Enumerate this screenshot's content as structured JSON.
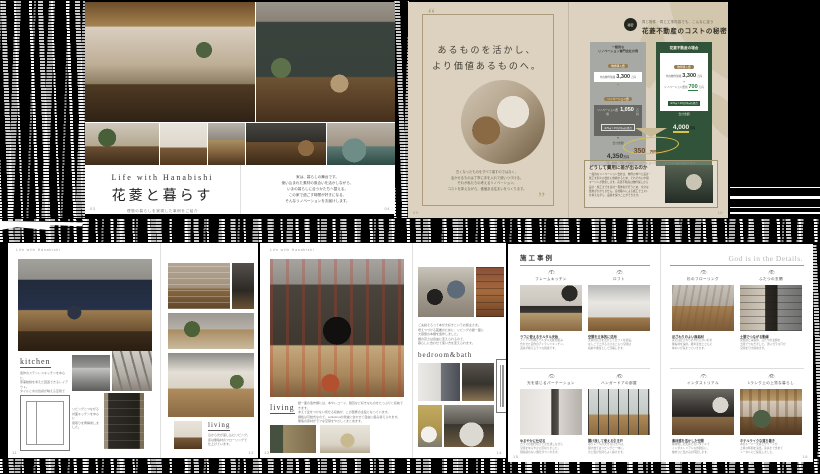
{
  "spread_top_left": {
    "title_en": "Life with Hanabishi",
    "title_jp": "花菱と暮らす",
    "subtitle": "理想の暮らしを実現した事例をご紹介",
    "intro_lines": [
      "家は、暮らしの舞台です。",
      "使い込まれた素材の風合いを活かしながら、",
      "いまの暮らしに合うかたちへ整える。",
      "この家で過ごす時間が好きになる、",
      "そんなリノベーションをお届けします。"
    ],
    "page_left": "03",
    "page_right": "04"
  },
  "spread_top_right": {
    "quote_open": "“",
    "quote_close": "”",
    "headline_line1": "あるものを活かし、",
    "headline_line2": "より価値あるものへ。",
    "quote_body_lines": [
      "古くなったものをすべて壊すのではなく、",
      "活かせるものは丁寧に手を入れて使いつづける。",
      "それが私たちの考えるリノベーション。",
      "コストを抑えながら、価値ある住まいをつくります。"
    ],
    "cost": {
      "badge_text": "秘密",
      "eyebrow": "同じ物件・同じ工事内容でも、こんなに違う",
      "title": "花菱不動産のコストの秘密",
      "card_general": {
        "title_line1": "一般的な",
        "title_line2": "リノベーション専門会社の例",
        "tag_purchase": "物件購入費",
        "purchase_label": "中古物件価格",
        "purchase_value": "3,300",
        "purchase_unit": "万円",
        "plus": "+",
        "tag_reno": "リノベーション費",
        "reno_label": "リノベーション費用",
        "reno_value": "1,050",
        "reno_unit": "万円",
        "reno_note": "※70㎡ × 15万円/㎡の場合",
        "arrow": "▼",
        "total_label": "合計金額",
        "total_value": "4,350",
        "total_unit": "万円"
      },
      "card_hanabishi": {
        "title": "花菱不動産の場合",
        "tag_purchase": "物件購入費",
        "purchase_label": "中古物件価格",
        "purchase_value": "3,300",
        "purchase_unit": "万円",
        "plus": "+",
        "reno_label": "リノベーション費用",
        "reno_value": "700",
        "reno_unit": "万円",
        "reno_note": "※70㎡ × 10万円/㎡の場合",
        "arrow": "▼",
        "total_label": "合計金額",
        "total_value": "4,000",
        "total_unit": "万円"
      },
      "savings_value": "350",
      "savings_unit": "万円もお得!",
      "savings_note": "同じ物件・同じ内容のリノベーションでも、これだけの差が生まれます",
      "reason_title": "どうして費用に差が出るのか",
      "reason_lines": [
        "一般的なリノベーション会社は、物件の仲介と設計・",
        "施工を別々の会社に依頼するため、それぞれに中間",
        "マージンが発生します。花菱不動産は物件探しから",
        "設計・施工までを自社一貫体制で行うため、余分な",
        "費用がかかりません。自社職人による施工でコスト",
        "を抑えながら、品質を保つことができます。"
      ]
    },
    "page_left": "09",
    "page_right": "10"
  },
  "spread_kitchen": {
    "running_header": "Life with Hanabishi",
    "kitchen_label": "kitchen",
    "kitchen_lines": [
      "造作のステンレスキッチンを中心に、",
      "家事動線を考えた回遊できるレイアウト。",
      "タイルと木の質感が映える空間です。"
    ],
    "plan_lines": [
      "リビングとつながる",
      "対面キッチンを中心に",
      "間取りを再構成しました。"
    ],
    "living_label": "living",
    "living_lines": [
      "窓から光が差し込むリビング。",
      "床は無垢材のフローリングで",
      "仕上げています。"
    ],
    "page_left": "11",
    "page_right": "12"
  },
  "spread_living": {
    "running_header": "Life with Hanabishi",
    "living_label": "living",
    "living_lines": [
      "壁一面の造作棚には、本やレコード、雑貨など好きなものをたっぷりと収納できます。",
      "あえて扉をつけない見せる収納が、この部屋の主役になっています。",
      "棚板は可動式なので、collectionの増減に合わせて自由に組み替えられます。",
      "無垢の床材がラフな空間をやさしくまとめます。"
    ],
    "episode_lines": [
      "ご夫婦そろって本が大好きというお施主さま。",
      "増えつづける蔵書のために、リビングの壁一面に",
      "大容量の本棚を造作しました。",
      "棚の高さは自由に変えられるので、",
      "暮らしに合わせて使い方を変えられます。"
    ],
    "bedroom_label": "bedroom&bath",
    "page_left": "13",
    "page_right": "14"
  },
  "spread_cases": {
    "title": "施工事例",
    "motto": "God is in the Details.",
    "items": [
      {
        "no": "1.",
        "title": "フレームキッチン",
        "caption": "ラフに使えるモルタル天板",
        "lines": [
          "アイアンの脚とモルタル天板を組み",
          "合わせた造作のアイランドキッチン。",
          "道具が映えるラフな質感です。"
        ]
      },
      {
        "no": "2.",
        "title": "ロフト",
        "caption": "空間を立体的に活用",
        "lines": [
          "天井の高さを活かしてロフトを新設。",
          "はしごで上がる小さなこもり空間は",
          "収納や書斎として活躍します。"
        ]
      },
      {
        "no": "3.",
        "title": "杉のフローリング",
        "caption": "足ざわりのよい無垢材",
        "lines": [
          "床には足ざわりのやわらかい杉の",
          "無垢材を採用。経年変化とともに",
          "味わいが深まっていきます。"
        ]
      },
      {
        "no": "4.",
        "title": "ふたつの玄関",
        "caption": "土間でつながる動線",
        "lines": [
          "家族用と来客用、ふたつの玄関を",
          "土間でつなぎました。黒いガラス戸が",
          "空間を引き締めます。"
        ]
      },
      {
        "no": "5.",
        "title": "光を感じるパーテーション",
        "caption": "ゆるやかに仕切る",
        "lines": [
          "ガラスの間仕切りで光を通しながら",
          "空間をゆるやかに区切りました。",
          "閉塞感のない個室がつくれます。"
        ]
      },
      {
        "no": "6.",
        "title": "ハンガードアの部屋",
        "caption": "開け放して使える引き戸",
        "lines": [
          "吊りレールの大きな引き戸は、",
          "開け放てばリビングと一体に。",
          "光と風が気持ちよく抜けます。"
        ]
      },
      {
        "no": "7.",
        "title": "インダストリアル",
        "caption": "素材感を活かした空間",
        "lines": [
          "躯体現しの天井と黒いタイルで",
          "インダストリアルな雰囲気に。",
          "無骨さと温かみが同居します。"
        ]
      },
      {
        "no": "8.",
        "title": "1ランク上の上質な暮らし",
        "caption": "ホテルライクな落ち着き",
        "lines": [
          "木のルーバー天井とグリーンが",
          "上質な時間を演出。家具まで含めて",
          "トータルにご提案しました。"
        ]
      }
    ],
    "page_left": "15",
    "page_right": "16"
  }
}
